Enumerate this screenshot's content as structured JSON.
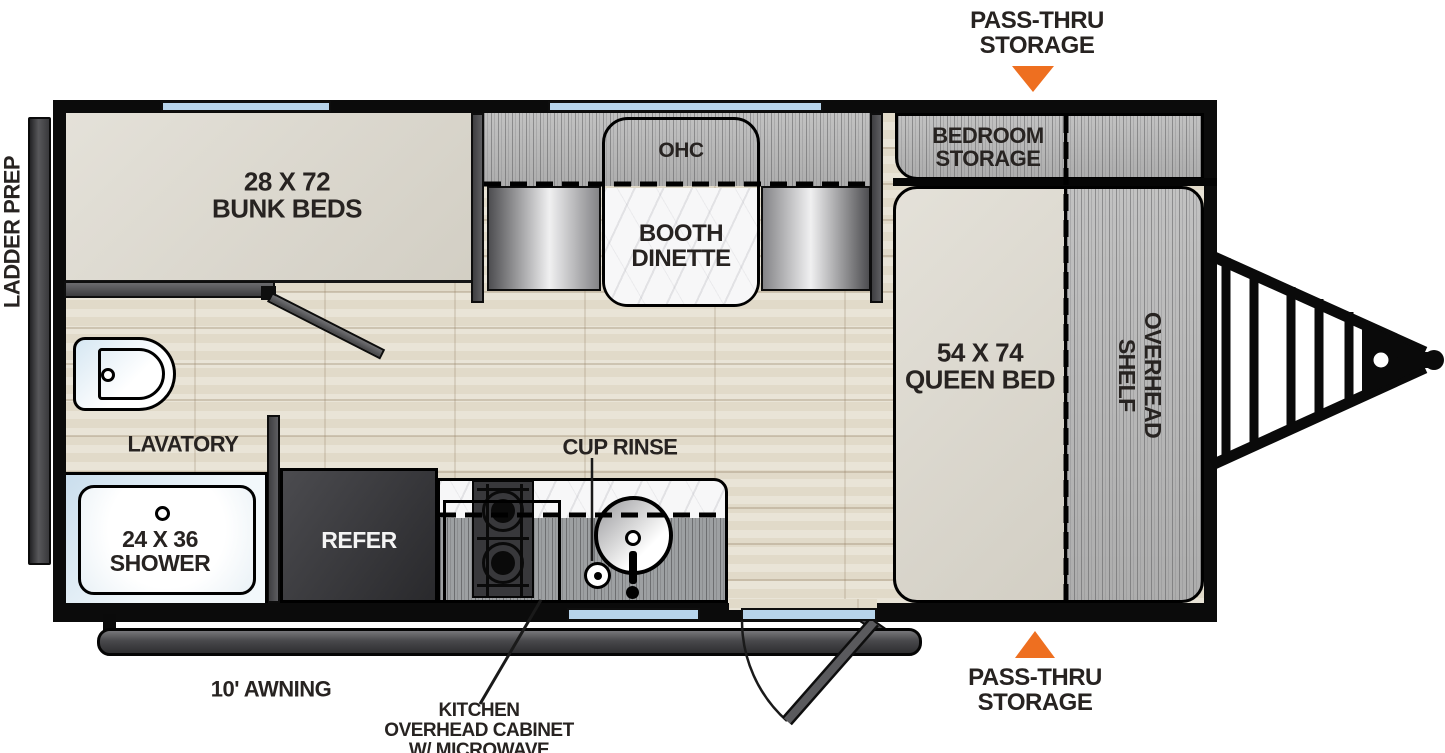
{
  "floorplan": {
    "exterior": {
      "ladder_prep": "LADDER PREP",
      "pass_thru_storage_top": "PASS-THRU\nSTORAGE",
      "pass_thru_storage_bottom": "PASS-THRU\nSTORAGE",
      "awning": "10' AWNING"
    },
    "callouts": {
      "kitchen_overhead": "KITCHEN\nOVERHEAD CABINET\nW/ MICROWAVE",
      "cup_rinse": "CUP RINSE"
    },
    "areas": {
      "bunk_beds": "28 X 72\nBUNK BEDS",
      "overhead_cabinet": "OHC",
      "booth_dinette": "BOOTH\nDINETTE",
      "bedroom_storage": "BEDROOM\nSTORAGE",
      "queen_bed": "54 X 74\nQUEEN BED",
      "overhead_shelf": "OVERHEAD\nSHELF",
      "lavatory": "LAVATORY",
      "shower": "24 X 36\nSHOWER",
      "refrigerator": "REFER"
    },
    "colors": {
      "accent_orange": "#ee6f20",
      "window_blue": "#b7d4eb",
      "wall_black": "#0b0b0b",
      "floor_tan": "#e7e1d3",
      "bed_gray": "#dbd7cc"
    }
  }
}
